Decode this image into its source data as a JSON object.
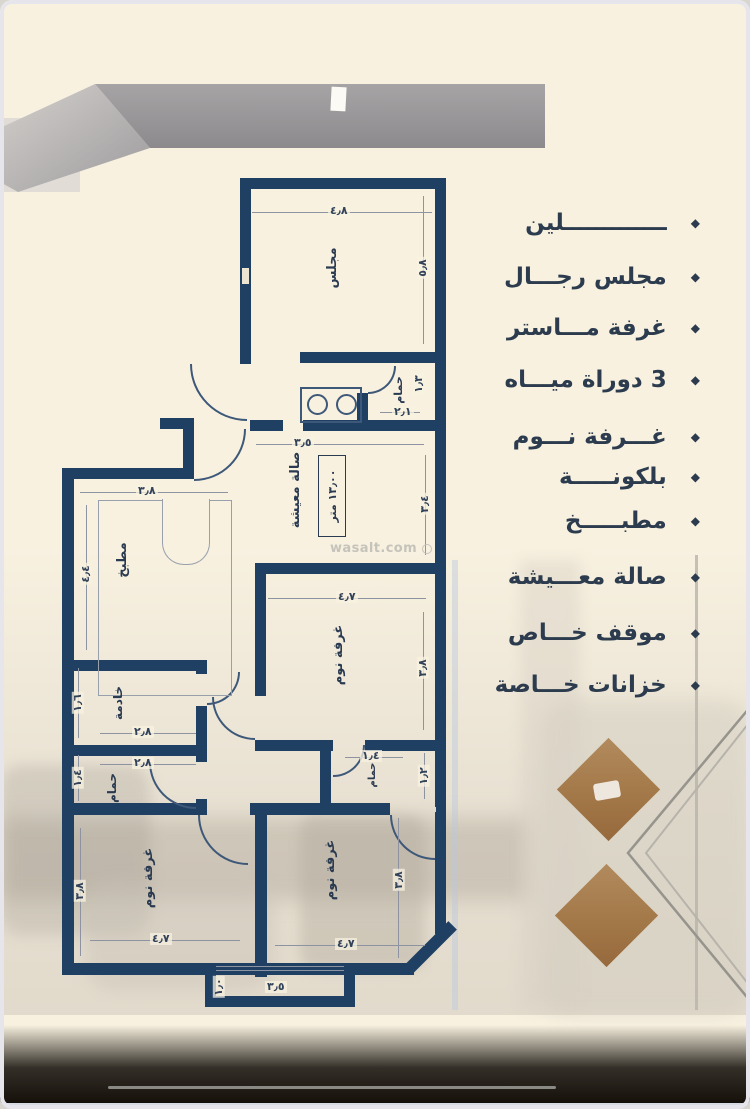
{
  "listing": {
    "bullet": "◆",
    "features": [
      "ـــــــــــــلين",
      "مجلس رجـــال",
      "غرفة مـــاستر",
      "3 دوراة ميـــاه",
      "غـــرفة نـــوم",
      "بلكونـــــة",
      "مطبـــــخ",
      "صالة معـــيشة",
      "موقف خـــاص",
      "خزانات خـــاصة"
    ]
  },
  "plan": {
    "watermark": "wasalt.com",
    "rooms": {
      "majlis": {
        "label": "مجلس",
        "width": "٤٫٨",
        "height": "٥٫٨"
      },
      "bath_top": {
        "label": "حمام",
        "width": "٢٫١",
        "height": "١٫٣"
      },
      "living": {
        "label": "صالة معيشة",
        "area": "١٣٫٠٠ متر",
        "width": "٣٫٥",
        "height": "٣٫٤"
      },
      "kitchen": {
        "label": "مطبخ",
        "width": "٣٫٨",
        "height": "٤٫٤"
      },
      "bedroom_mid": {
        "label": "غرفة نوم",
        "width": "٤٫٧",
        "height": "٣٫٨"
      },
      "maid": {
        "label": "خادمة",
        "width": "٢٫٨",
        "height": "١٫٦"
      },
      "bath_left": {
        "label": "حمام",
        "width": "٢٫٨",
        "height": "١٫٤"
      },
      "bath_small": {
        "label": "حمام",
        "width": "١٫٤",
        "height": "١٫٢"
      },
      "bedroom_bl": {
        "label": "غرفة نوم",
        "width": "٤٫٧",
        "height": "٣٫٨"
      },
      "bedroom_br": {
        "label": "غرفة نوم",
        "width": "٤٫٧",
        "height": "٣٫٨"
      },
      "balcony": {
        "width": "٣٫٥",
        "height": "١٫٠"
      }
    }
  }
}
